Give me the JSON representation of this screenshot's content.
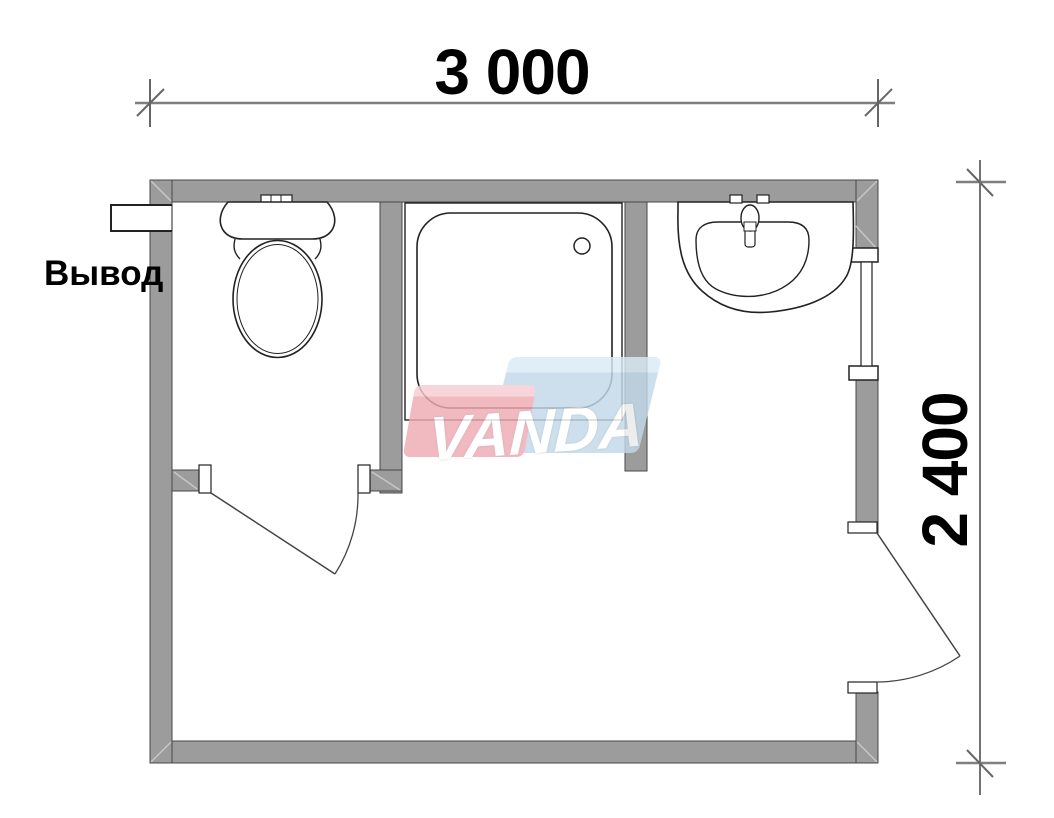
{
  "plan": {
    "dimensions": {
      "width_label": "3 000",
      "height_label": "2 400"
    },
    "labels": {
      "outlet": "Вывод"
    },
    "watermark": {
      "text": "VANDA",
      "pink_color": "#efaab3",
      "blue_color": "#c3d9e9",
      "text_color": "#ffffff"
    },
    "fixtures": [
      {
        "name": "toilet"
      },
      {
        "name": "shower-tray"
      },
      {
        "name": "washbasin"
      }
    ],
    "colors": {
      "wall": "#9c9c9c",
      "dimension_line": "#7f7f7f",
      "drawing_line": "#222222",
      "text": "#000000",
      "background": "#ffffff"
    }
  }
}
